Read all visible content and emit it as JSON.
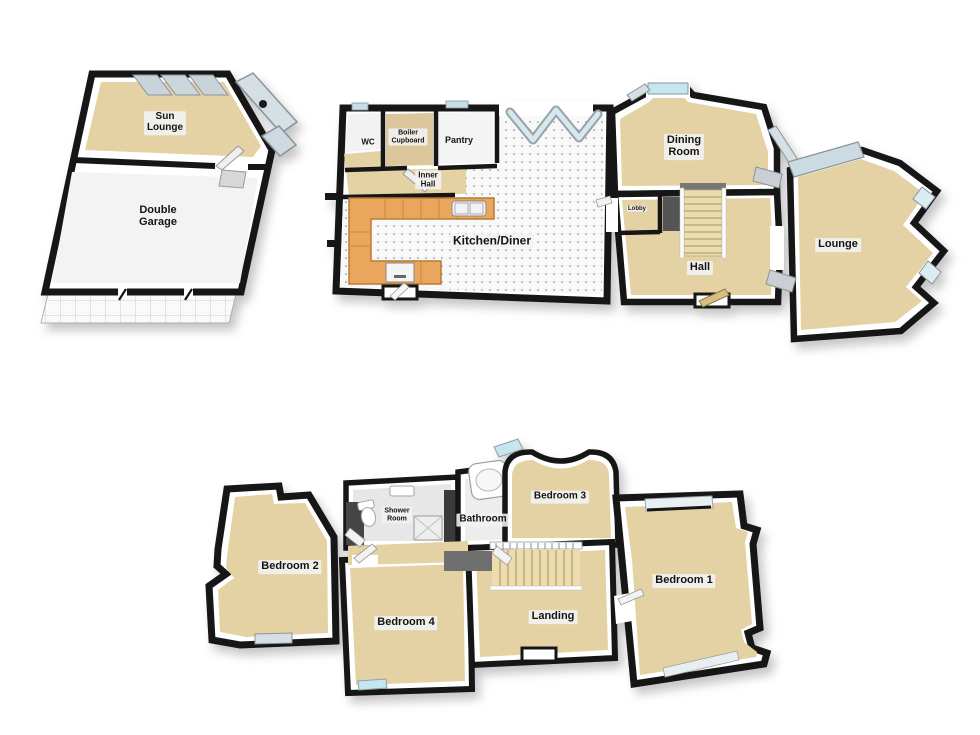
{
  "floors": {
    "outbuilding": {
      "rooms": [
        {
          "id": "sun-lounge",
          "label": "Sun\nLounge"
        },
        {
          "id": "double-garage",
          "label": "Double\nGarage"
        }
      ]
    },
    "ground_floor": {
      "rooms": [
        {
          "id": "wc",
          "label": "WC"
        },
        {
          "id": "boiler-cupboard",
          "label": "Boiler\nCupboard"
        },
        {
          "id": "pantry",
          "label": "Pantry"
        },
        {
          "id": "inner-hall",
          "label": "Inner\nHall"
        },
        {
          "id": "kitchen-diner",
          "label": "Kitchen/Diner"
        },
        {
          "id": "dining-room",
          "label": "Dining\nRoom"
        },
        {
          "id": "lobby",
          "label": "Lobby"
        },
        {
          "id": "hall",
          "label": "Hall"
        },
        {
          "id": "lounge",
          "label": "Lounge"
        }
      ]
    },
    "first_floor": {
      "rooms": [
        {
          "id": "bedroom-2",
          "label": "Bedroom 2"
        },
        {
          "id": "shower-room",
          "label": "Shower\nRoom"
        },
        {
          "id": "bathroom",
          "label": "Bathroom"
        },
        {
          "id": "bedroom-3",
          "label": "Bedroom 3"
        },
        {
          "id": "bedroom-4",
          "label": "Bedroom 4"
        },
        {
          "id": "landing",
          "label": "Landing"
        },
        {
          "id": "bedroom-1",
          "label": "Bedroom 1"
        }
      ]
    }
  },
  "colors": {
    "wall": "#161616",
    "wall_face": "#ffffff",
    "floor_tan": "#e4d2a4",
    "floor_white": "#f6f6f6",
    "kitchen_counter": "#e9a65c",
    "window_glass": "#cfe6ee",
    "roof_glass": "#ccd7dd",
    "stairs": "#ecdcae",
    "stair_void": "#6f6f6f",
    "background": "#ffffff"
  }
}
